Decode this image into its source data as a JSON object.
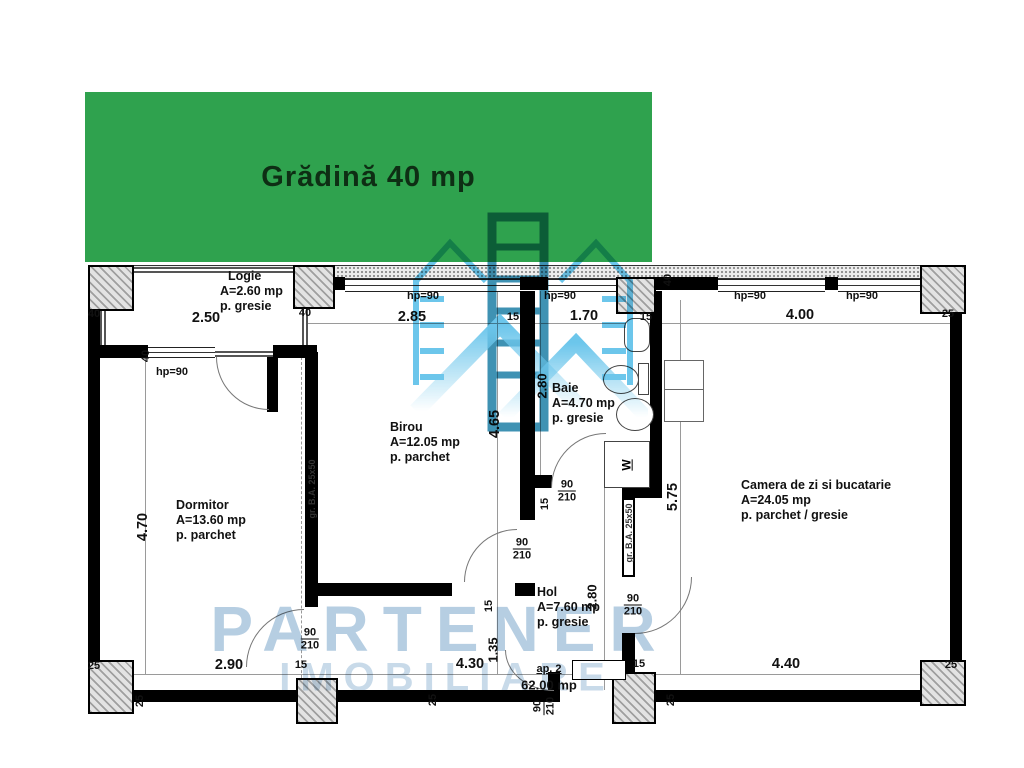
{
  "garden": {
    "label": "Grădină 40 mp",
    "color": "#2fa24e"
  },
  "watermark": {
    "line1": "PARTENER",
    "line2": "IMOBILIARE"
  },
  "apartment": {
    "label": "ap. 2",
    "area": "62.00 mp"
  },
  "rooms": {
    "logie": {
      "name": "Logie",
      "area": "A=2.60 mp",
      "floor": "p. gresie"
    },
    "dormitor": {
      "name": "Dormitor",
      "area": "A=13.60 mp",
      "floor": "p. parchet"
    },
    "birou": {
      "name": "Birou",
      "area": "A=12.05 mp",
      "floor": "p. parchet"
    },
    "baie": {
      "name": "Baie",
      "area": "A=4.70 mp",
      "floor": "p. gresie"
    },
    "camera": {
      "name": "Camera de zi si bucatarie",
      "area": "A=24.05 mp",
      "floor": "p. parchet / gresie"
    },
    "hol": {
      "name": "Hol",
      "area": "A=7.60 mp",
      "floor": "p. gresie"
    }
  },
  "dims": {
    "top": {
      "a": "40",
      "b": "2.50",
      "c": "40",
      "d": "2.85",
      "e": "15",
      "f": "1.70",
      "g": "15",
      "h": "4.00",
      "i": "25"
    },
    "bottom": {
      "a": "25",
      "b": "2.90",
      "c": "15",
      "d": "4.30",
      "e": "1.35",
      "f": "15",
      "g": "4.40",
      "h": "25"
    },
    "vertical": {
      "left": "4.70",
      "birou": "4.65",
      "baie": "2.80",
      "hol": "2.80",
      "camera": "5.75",
      "logia_window": "40",
      "camera_top": "40",
      "baie_wall": "15",
      "birou_wall": "15"
    },
    "wall_thickness": "25"
  },
  "labels": {
    "window_height": "hp=90",
    "door_width": "90",
    "door_height": "210",
    "beam": "gr. B.A. 25x50",
    "washing_machine": "W"
  },
  "colors": {
    "garden_green": "#2fa24e",
    "watermark_light_blue": "#52bce8",
    "watermark_dark_blue": "#1d7fa6",
    "watermark_text": "#a9c6dd",
    "wall_black": "#000000"
  }
}
